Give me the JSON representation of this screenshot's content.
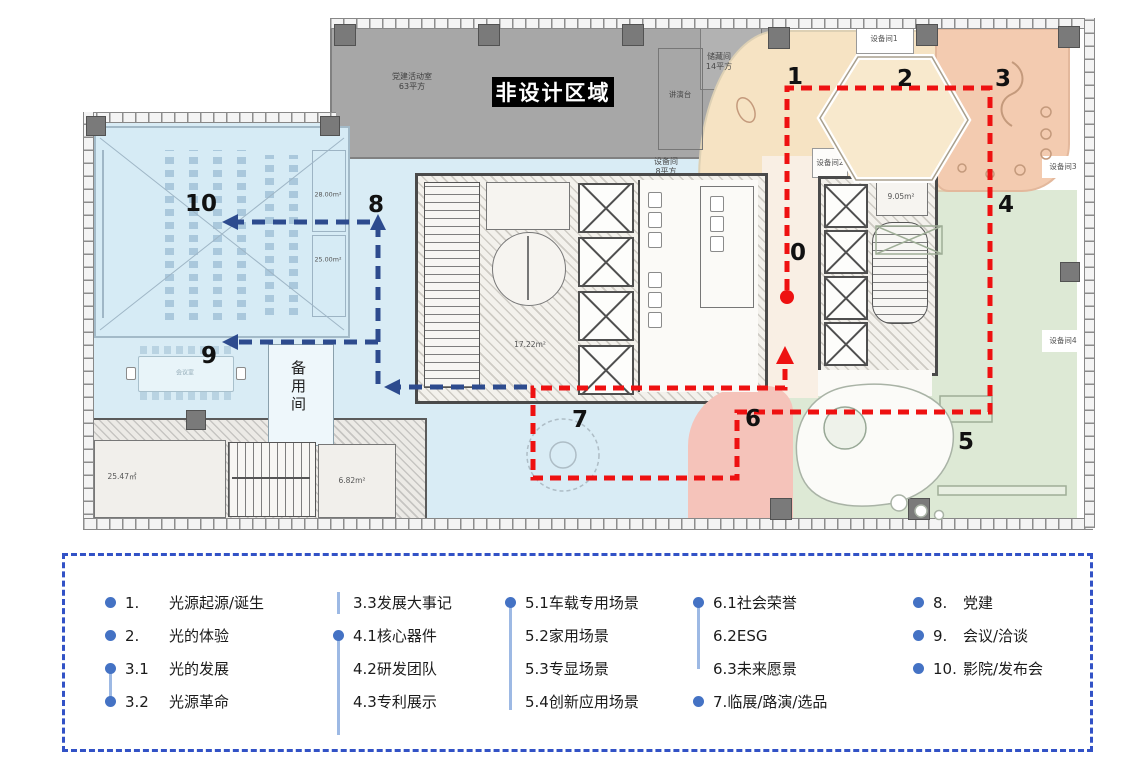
{
  "plan": {
    "badge": "非设计区域",
    "rooms": {
      "party_room": "党建活动室",
      "party_room_area": "63平方",
      "storage": "储藏间",
      "storage_area": "14平方",
      "podium": "讲演台",
      "equip_small": "设备间",
      "equip_small_area": "8平方",
      "equip1": "设备间1",
      "equip2": "设备间2",
      "equip3": "设备间3",
      "equip4": "设备间4",
      "backup_room": "备用间",
      "meeting_room": "会议室",
      "area_28": "28.00m²",
      "area_25": "25.00m²",
      "area_1722": "17.22m²",
      "area_905": "9.05m²",
      "area_2547": "25.47㎡",
      "area_682": "6.82m²"
    },
    "route_numbers": {
      "n0": "0",
      "n1": "1",
      "n2": "2",
      "n3": "3",
      "n4": "4",
      "n5": "5",
      "n6": "6",
      "n7": "7",
      "n8": "8",
      "n9": "9",
      "n10": "10"
    },
    "colors": {
      "route_red": "#ee1111",
      "route_blue": "#2d4b8e",
      "zone_blue": "#d9ecf5",
      "zone_green": "#dde9d5",
      "zone_cream": "#f6e3c3",
      "zone_salmon": "#f3cbb0",
      "zone_pink": "#f5c3ba",
      "non_design_gray": "#a7a7a7"
    }
  },
  "legend": {
    "border_color": "#3252c6",
    "bullet_color": "#4472c4",
    "columns": [
      {
        "items": [
          {
            "num": "1.",
            "label": "光源起源/诞生"
          },
          {
            "num": "2.",
            "label": "光的体验"
          },
          {
            "num": "3.1",
            "label": "光的发展"
          },
          {
            "num": "3.2",
            "label": "光源革命"
          }
        ]
      },
      {
        "items": [
          {
            "num": "3.3",
            "label": "发展大事记"
          },
          {
            "num": "4.1",
            "label": "核心器件"
          },
          {
            "num": "4.2",
            "label": "研发团队"
          },
          {
            "num": "4.3",
            "label": "专利展示"
          }
        ]
      },
      {
        "items": [
          {
            "num": "5.1",
            "label": "车载专用场景"
          },
          {
            "num": "5.2",
            "label": "家用场景"
          },
          {
            "num": "5.3",
            "label": "专显场景"
          },
          {
            "num": "5.4",
            "label": "创新应用场景"
          }
        ]
      },
      {
        "items": [
          {
            "num": "6.1",
            "label": "社会荣誉"
          },
          {
            "num": "6.2",
            "label": "ESG"
          },
          {
            "num": "6.3",
            "label": "未来愿景"
          },
          {
            "num": "7.",
            "label": "临展/路演/选品"
          }
        ]
      },
      {
        "items": [
          {
            "num": "8.",
            "label": "党建"
          },
          {
            "num": "9.",
            "label": "会议/洽谈"
          },
          {
            "num": "10.",
            "label": "影院/发布会"
          }
        ]
      }
    ]
  }
}
